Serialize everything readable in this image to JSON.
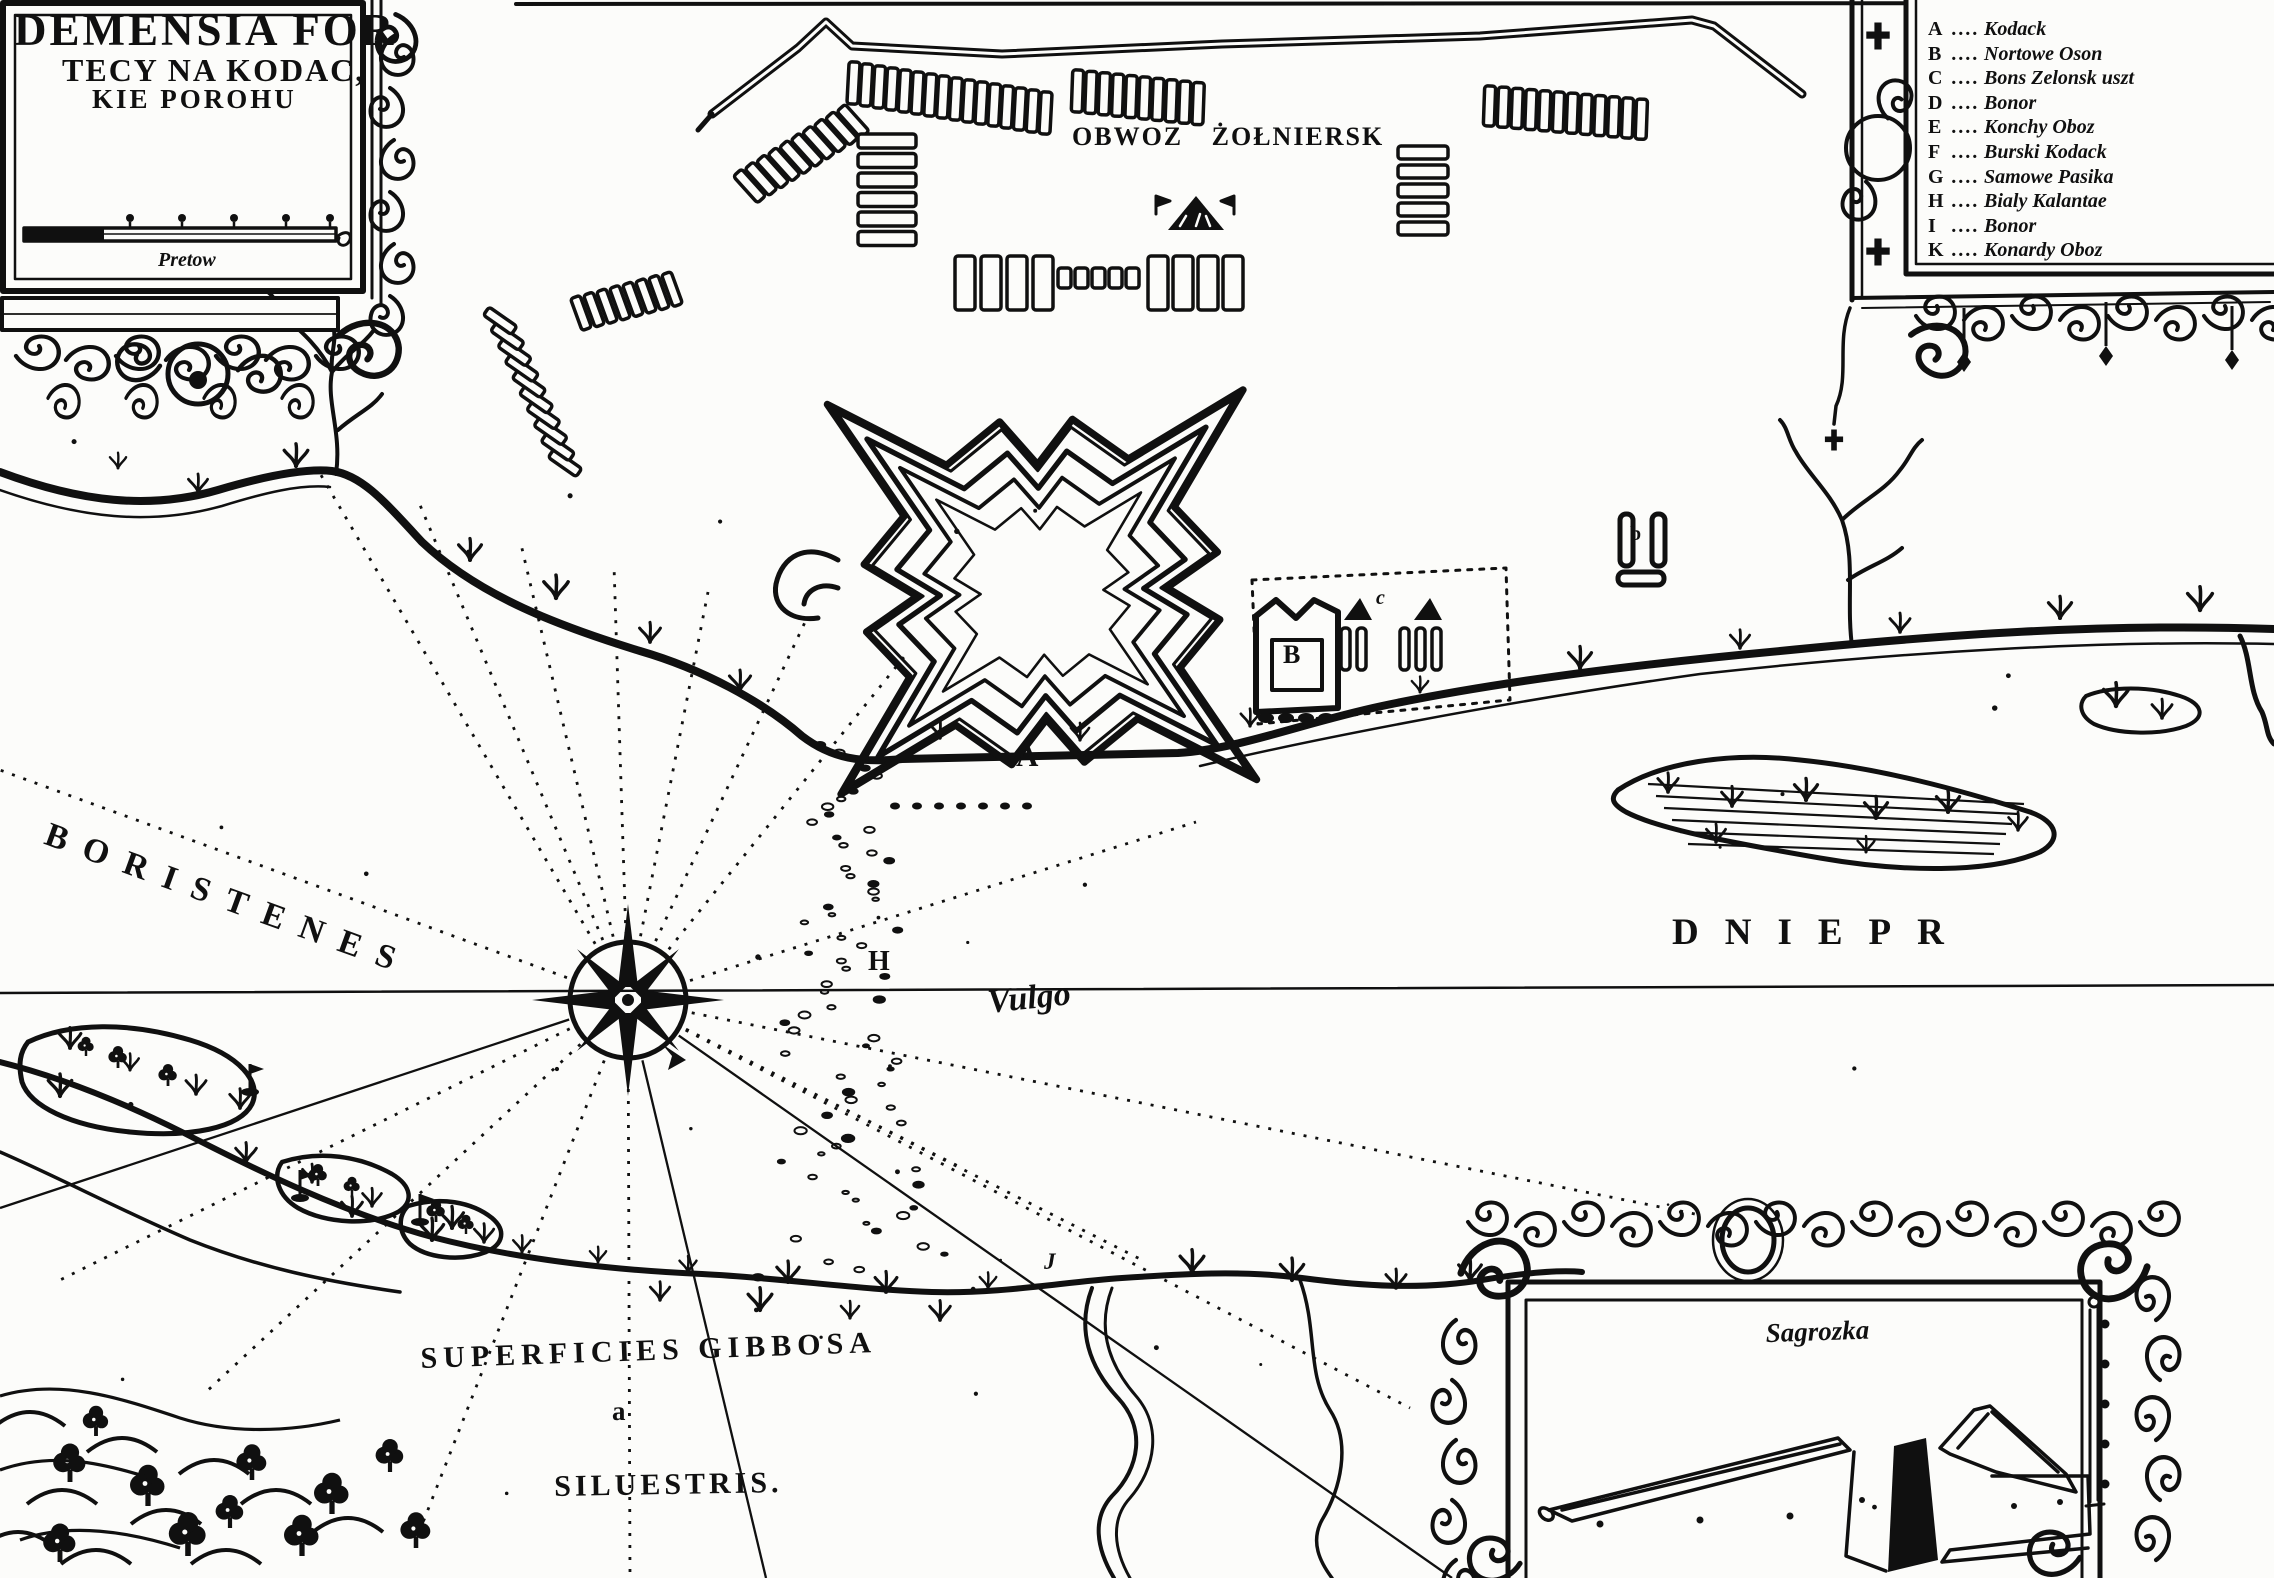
{
  "theme": {
    "ink": "#101010",
    "paper": "#fcfcfa"
  },
  "title_cartouche": {
    "line1": "DEMENSIA FOR",
    "line2": "TECY NA KODAC,",
    "line3": "KIE POROHU",
    "scale_label": "Pretow"
  },
  "camp": {
    "label": "OBWOZ ŻOŁNIERSK"
  },
  "legend": {
    "leader": "....",
    "items": [
      {
        "letter": "A",
        "label": "Kodack"
      },
      {
        "letter": "B",
        "label": "Nortowe Oson"
      },
      {
        "letter": "C",
        "label": "Bons Zelonsk uszt"
      },
      {
        "letter": "D",
        "label": "Bonor"
      },
      {
        "letter": "E",
        "label": "Konchy Oboz"
      },
      {
        "letter": "F",
        "label": "Burski Kodack"
      },
      {
        "letter": "G",
        "label": "Samowe Pasika"
      },
      {
        "letter": "H",
        "label": "Bialy Kalantae"
      },
      {
        "letter": "I",
        "label": "Bonor"
      },
      {
        "letter": "K",
        "label": "Konardy Oboz"
      }
    ]
  },
  "river_labels": {
    "boristenes": "BORISTENES",
    "dniepr": "DNIEPR",
    "vulgo": "Vulgo"
  },
  "terrain_labels": {
    "line1": "SUPERFICIES GIBBOSA",
    "line2": "a",
    "line3": "SILUESTRIS."
  },
  "map_letters": {
    "fort": "A",
    "fortlet": "B",
    "camp_small": "c",
    "rapids": "H",
    "stream": "J",
    "building": "b"
  },
  "profile_cartouche": {
    "title": "Sagrozka"
  }
}
